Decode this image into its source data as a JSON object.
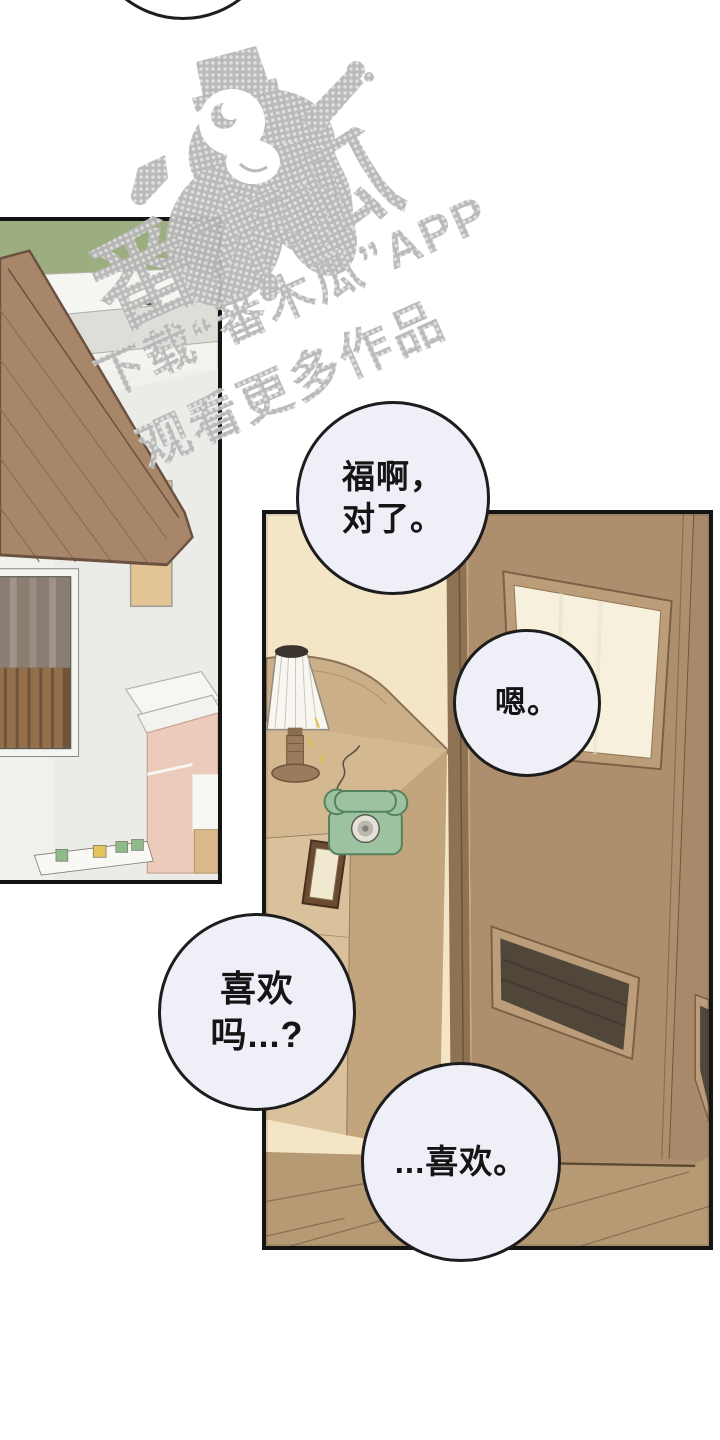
{
  "watermark": {
    "brand": "番木瓜",
    "caption_line1": "下载“番木瓜”APP",
    "caption_line2": "观看更多作品",
    "color": "#b7b7b7"
  },
  "bubbles": [
    {
      "lines": [
        "福啊，",
        "对了。"
      ]
    },
    {
      "lines": [
        "嗯。"
      ]
    },
    {
      "lines": [
        "喜欢",
        "吗...?"
      ]
    },
    {
      "lines": [
        "...喜欢。"
      ]
    }
  ],
  "palette": {
    "panel_border": "#141414",
    "bubble_fill": "#efeff8",
    "hedge_green": "#9cae7f",
    "roof_brown": "#a8866a",
    "wall_cream": "#f3e5c6",
    "door_brown": "#ad8f6d",
    "floor_brown": "#b59a74",
    "phone_green": "#9dc2a0",
    "kiosk_pink": "#edcbbc",
    "vent_dark": "#51463a"
  }
}
